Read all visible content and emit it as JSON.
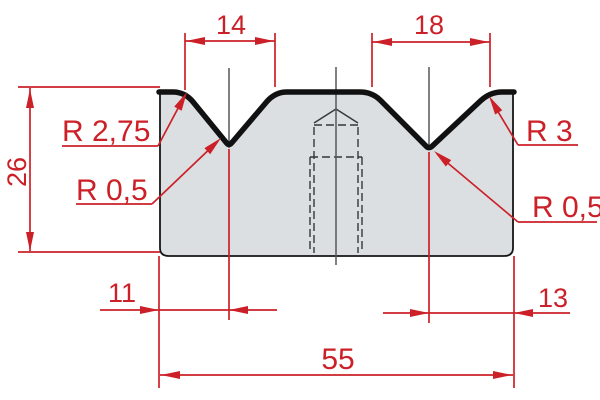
{
  "title": "2V die cross-section technical drawing",
  "drawing": {
    "dim_top_left": "14",
    "dim_top_right": "18",
    "dim_height": "26",
    "dim_bottom_left": "11",
    "dim_bottom_right": "13",
    "dim_overall_width": "55",
    "label_radius_left_shoulder": "R 2,75",
    "label_radius_left_vee": "R 0,5",
    "label_radius_right_shoulder": "R 3",
    "label_radius_right_vee": "R 0,5",
    "colors": {
      "dimension_red": "#cc2028",
      "body_fill": "#dbdfe2",
      "outline_black": "#161616",
      "centerline_gray": "#54585c"
    }
  }
}
